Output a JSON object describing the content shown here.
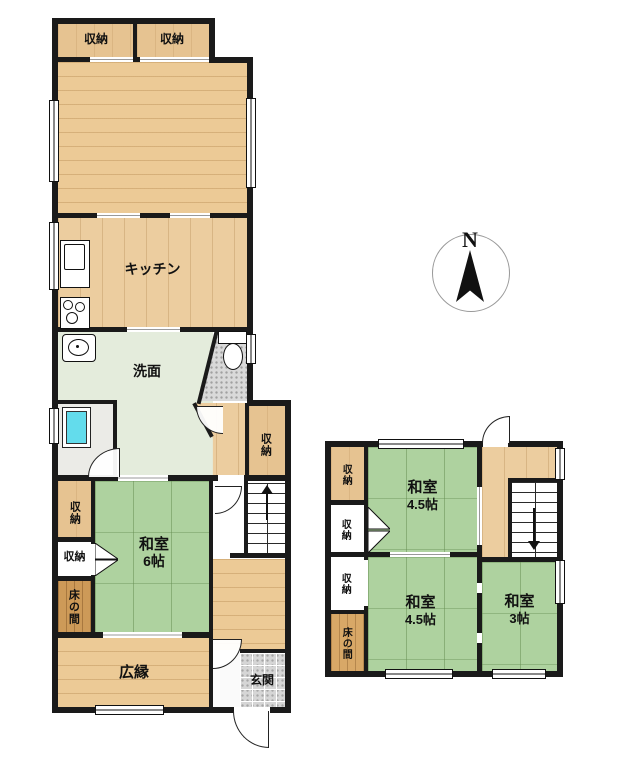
{
  "palette": {
    "wall": "#1a1a1a",
    "wood_floor": "#ecca96",
    "closet_wood": "#e6c391",
    "tokonoma_wood": "#cd9a58",
    "tatami_green": "#aed29f",
    "washroom_floor": "#e4ecdc",
    "tile_gray": "#d6d6d6",
    "bath_tub_cyan": "#63dcec",
    "background": "#ffffff"
  },
  "compass": {
    "north_label": "N"
  },
  "floor1": {
    "closet_top_left": "収納",
    "closet_top_right": "収納",
    "kitchen": "キッチン",
    "washroom": "洗面",
    "hall_storage": "収納",
    "tatami_storage_upper": "収納",
    "tatami_storage_lower": "収納",
    "tokonoma": "床の間",
    "washitsu": {
      "name": "和室",
      "size": "6帖"
    },
    "hiroen": "広縁",
    "genkan": "玄関"
  },
  "floor2": {
    "storage_top": "収納",
    "storage_middle": "収納",
    "storage_lower": "収納",
    "tokonoma": "床の間",
    "washitsu_north": {
      "name": "和室",
      "size": "4.5帖"
    },
    "washitsu_south": {
      "name": "和室",
      "size": "4.5帖"
    },
    "washitsu_east": {
      "name": "和室",
      "size": "3帖"
    }
  }
}
